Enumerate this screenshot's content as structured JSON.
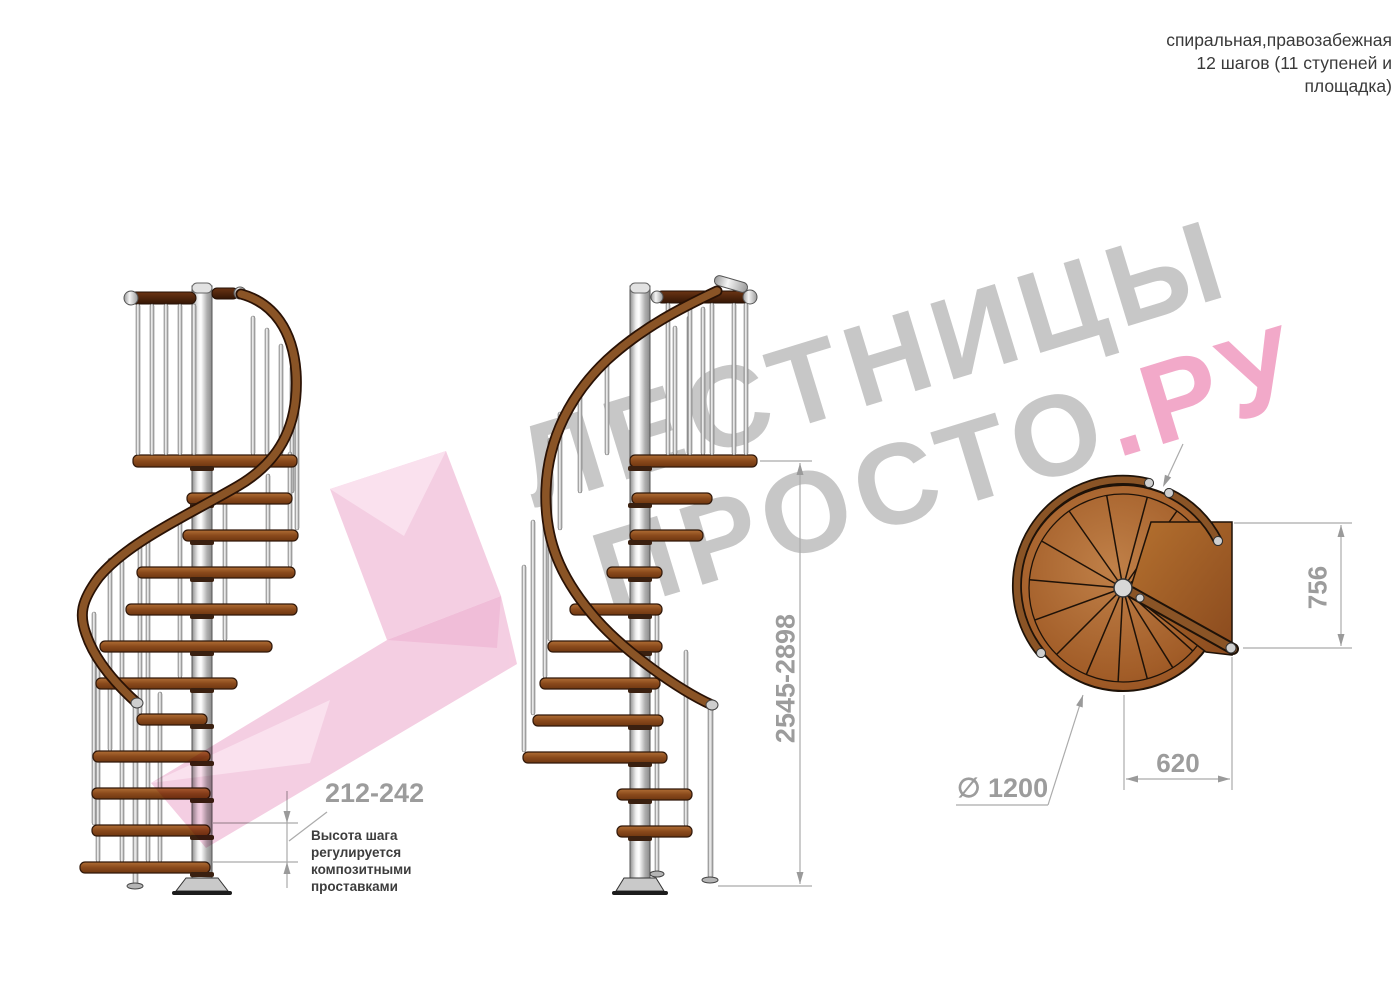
{
  "title_block": {
    "line1": "спиральная,правозабежная",
    "line2": "12 шагов (11 ступеней и",
    "line3": "площадка)"
  },
  "watermark": {
    "line1": "ЛЕСТНИЦЫ",
    "line2_gray": "ПРОСТО",
    "line2_pink": ".РУ",
    "gray_color": "#c7c7c7",
    "pink_color": "#f2a9c9"
  },
  "dimensions": {
    "total_height": "2545-2898",
    "step_height": "212-242",
    "platform_depth": "756",
    "platform_width": "620",
    "diameter": "∅ 1200",
    "note_lines": [
      "Высота шага",
      "регулируется",
      "композитными",
      "проставками"
    ]
  },
  "colors": {
    "dim_gray": "#9c9c9c",
    "line_gray": "#ababab",
    "wood": "#8a4a1c",
    "dark_wood": "#4a240c",
    "metal": "#c0c0c0",
    "arrow_pink": "#f2c3da"
  },
  "views": {
    "left": "side view",
    "center": "side view rotated",
    "right": "plan view"
  }
}
